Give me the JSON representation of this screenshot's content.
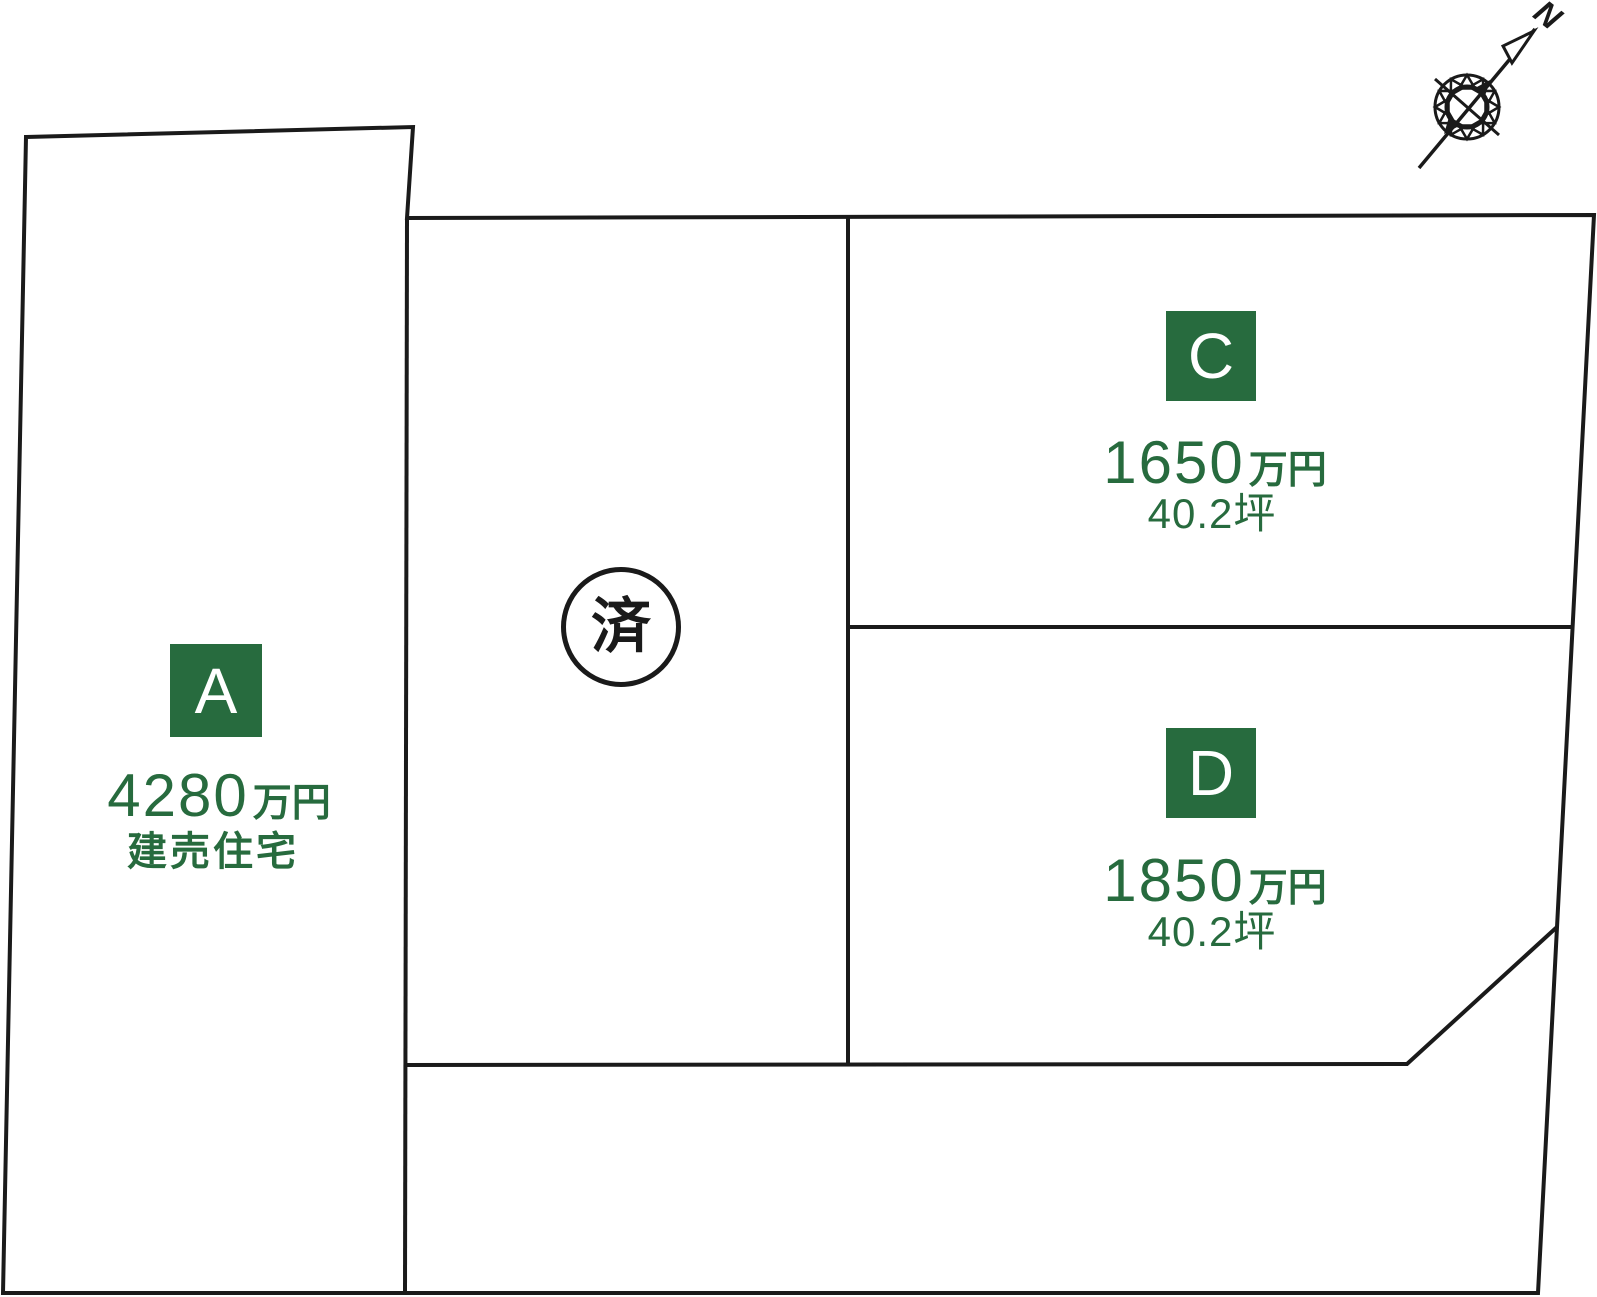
{
  "page": {
    "background": "#FFFFFF",
    "colors": {
      "badge_green": "#276B3E",
      "text_green": "#276B3E",
      "line_black": "#1A1A1A"
    }
  },
  "compass": {
    "north_label": "N"
  },
  "lots": {
    "a": {
      "label": "A",
      "price_number": "4280",
      "price_unit": "万円",
      "note": "建売住宅"
    },
    "c": {
      "label": "C",
      "price_number": "1650",
      "price_unit": "万円",
      "area": "40.2坪"
    },
    "d": {
      "label": "D",
      "price_number": "1850",
      "price_unit": "万円",
      "area": "40.2坪"
    },
    "sold": {
      "status_label": "済"
    }
  }
}
